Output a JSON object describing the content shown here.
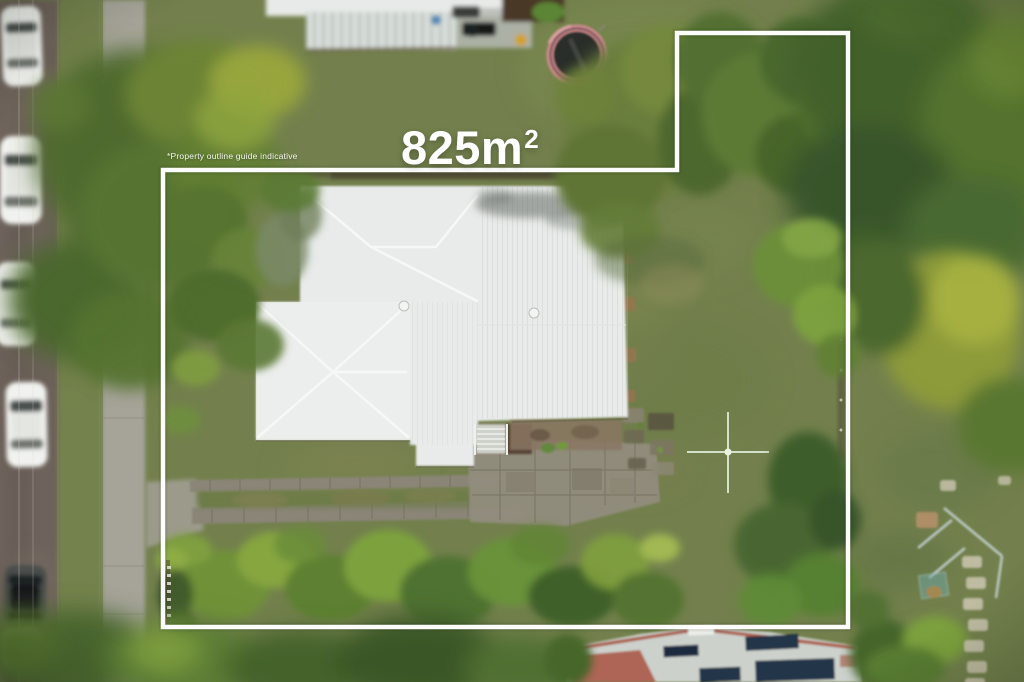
{
  "overlay": {
    "area_value": "825m",
    "area_superscript": "2",
    "area_full": "825m²",
    "disclaimer": "*Property outline guide indicative"
  },
  "colors": {
    "outline": "#ffffff",
    "grass": "#73804d",
    "grass_bright": "#7d8b52",
    "grass_dark": "#5e6f40",
    "road": "#6e645b",
    "footpath": "#a6a499",
    "driveway_track": "#8a8577",
    "paver": "#928d7e",
    "roof": "#e8ebe9",
    "roof_shade": "#dde2e0",
    "ridge_red": "#a8523f",
    "solar": "#203449",
    "tramp_rim": "#cf8b8f",
    "tramp_mat": "#2b2f2b",
    "car_white": "#f1f2ef",
    "car_dark": "#494e4b",
    "tree_dark": "#42602c",
    "tree_mid": "#5d7a34",
    "tree_bright": "#799c3c",
    "tree_yellow": "#9aa83e"
  },
  "scene": {
    "kind": "aerial-drone-photo-of-property",
    "objects": [
      "street-with-parked-cars",
      "footpath",
      "double-track-driveway",
      "main-house-roof",
      "front-lawn",
      "property-trees",
      "clothesline",
      "paved-patio",
      "neighbour-deck-top",
      "trampoline",
      "neighbour-house-bottom",
      "solar-panels",
      "swing-set",
      "stepping-stone-path",
      "property-outline"
    ]
  }
}
